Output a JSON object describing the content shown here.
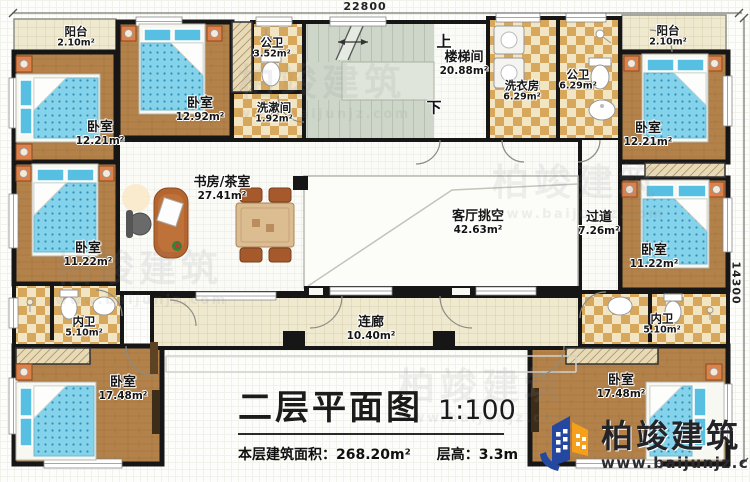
{
  "plan": {
    "dimension_top": "22800",
    "dimension_right": "14300",
    "stair_up": "上",
    "stair_down": "下"
  },
  "rooms": [
    {
      "name": "阳台",
      "area": "2.10m²"
    },
    {
      "name": "卧室",
      "area": "12.21m²"
    },
    {
      "name": "卧室",
      "area": "12.92m²"
    },
    {
      "name": "公卫",
      "area": "3.52m²"
    },
    {
      "name": "洗漱间",
      "area": "1.92m²"
    },
    {
      "name": "楼梯间",
      "area": "20.88m²"
    },
    {
      "name": "洗衣房",
      "area": "6.29m²"
    },
    {
      "name": "公卫",
      "area": "6.29m²"
    },
    {
      "name": "阳台",
      "area": "2.10m²"
    },
    {
      "name": "卧室",
      "area": "12.21m²"
    },
    {
      "name": "书房/茶室",
      "area": "27.41m²"
    },
    {
      "name": "客厅挑空",
      "area": "42.63m²"
    },
    {
      "name": "过道",
      "area": "7.26m²"
    },
    {
      "name": "卧室",
      "area": "11.22m²"
    },
    {
      "name": "卧室",
      "area": "11.22m²"
    },
    {
      "name": "内卫",
      "area": "5.10m²"
    },
    {
      "name": "连廊",
      "area": "10.40m²"
    },
    {
      "name": "内卫",
      "area": "5.10m²"
    },
    {
      "name": "卧室",
      "area": "17.48m²"
    },
    {
      "name": "卧室",
      "area": "17.48m²"
    }
  ],
  "title_block": {
    "title": "二层平面图",
    "scale": "1:100",
    "area_label": "本层建筑面积：",
    "area_value": "268.20m²",
    "height_label": "层高：",
    "height_value": "3.3m"
  },
  "logo": {
    "brand": "柏竣建筑",
    "site": "www.baijunjz.com"
  },
  "watermark": {
    "brand": "柏竣建筑",
    "site": "www.baijunjz.com"
  },
  "colors": {
    "wall": "#161616",
    "wood": "#b2824a",
    "tile": "#efe9cf",
    "checker": "#d7a85b",
    "bed_blue": "#85d3ea",
    "stair": "#cdd6c9",
    "logo_blue": "#2448a0",
    "logo_orange": "#f59f1b"
  }
}
